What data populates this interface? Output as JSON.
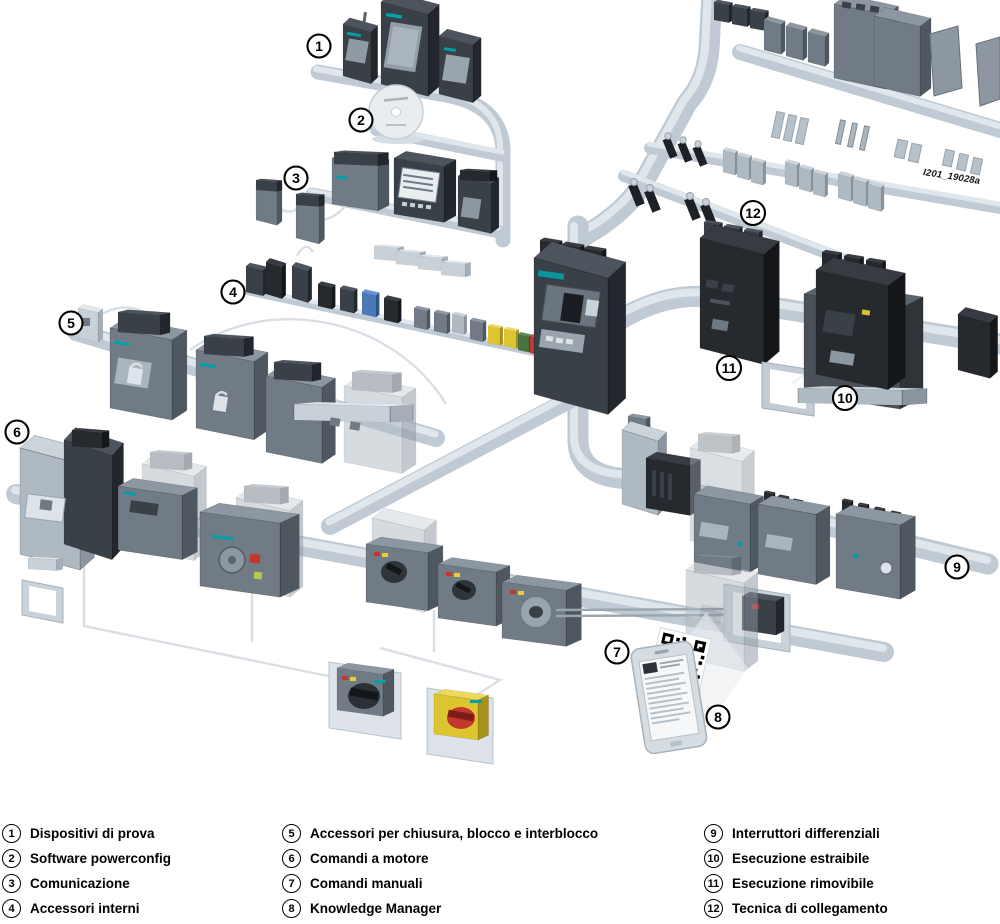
{
  "figure": {
    "watermark": "I201_19028a",
    "callouts": [
      {
        "num": "1"
      },
      {
        "num": "2"
      },
      {
        "num": "3"
      },
      {
        "num": "4"
      },
      {
        "num": "5"
      },
      {
        "num": "6"
      },
      {
        "num": "7"
      },
      {
        "num": "8"
      },
      {
        "num": "9"
      },
      {
        "num": "10"
      },
      {
        "num": "11"
      },
      {
        "num": "12"
      }
    ],
    "palette": {
      "pipe": "#bfcad4",
      "pipe_highlight": "#e0e7ec",
      "device_dark": "#3a4048",
      "device_darkest": "#26292e",
      "device_mid": "#707b86",
      "device_light": "#aeb9c2",
      "accent_teal": "#00a0a6",
      "accent_red": "#c23a31",
      "accent_yellow": "#ddc52f",
      "accent_green": "#47753f",
      "accent_blue": "#4a78b8"
    }
  },
  "legend": {
    "columns": [
      {
        "items": [
          {
            "num": "1",
            "label": "Dispositivi di prova"
          },
          {
            "num": "2",
            "label": "Software powerconfig"
          },
          {
            "num": "3",
            "label": "Comunicazione"
          },
          {
            "num": "4",
            "label": "Accessori interni"
          }
        ]
      },
      {
        "items": [
          {
            "num": "5",
            "label": "Accessori per chiusura, blocco e interblocco"
          },
          {
            "num": "6",
            "label": "Comandi a motore"
          },
          {
            "num": "7",
            "label": "Comandi manuali"
          },
          {
            "num": "8",
            "label": "Knowledge Manager"
          }
        ]
      },
      {
        "items": [
          {
            "num": "9",
            "label": "Interruttori differenziali"
          },
          {
            "num": "10",
            "label": "Esecuzione estraibile"
          },
          {
            "num": "11",
            "label": "Esecuzione rimovibile"
          },
          {
            "num": "12",
            "label": "Tecnica di collegamento"
          }
        ]
      }
    ]
  }
}
